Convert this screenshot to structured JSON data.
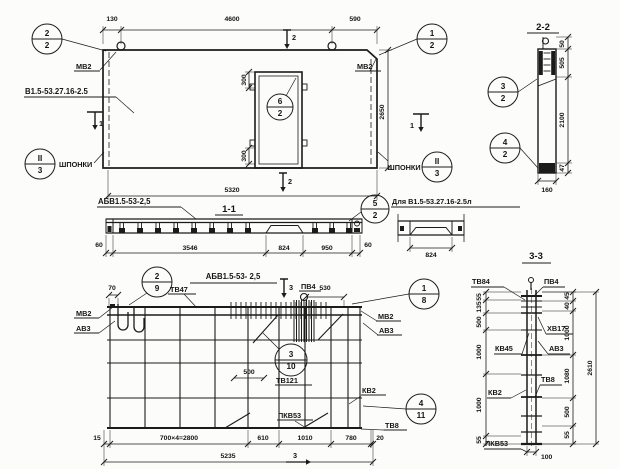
{
  "elevation": {
    "dims": {
      "offset": "130",
      "top": "4600",
      "corner": "590",
      "height": "2650",
      "length": "5320",
      "opening_top": "300",
      "opening_bottom": "300"
    },
    "labels": {
      "mv2_left": "МВ2",
      "mv2_right": "МВ2",
      "panel_mark": "В1.5-53.27.16-2.5",
      "keys_left": "ШПОНКИ",
      "keys_right": "ШПОНКИ"
    },
    "marks": {
      "m1_left": "1",
      "m1_right": "1",
      "m2_top": "2",
      "m2_bottom": "2"
    },
    "callouts": {
      "top_left": {
        "num": "2",
        "den": "2"
      },
      "top_right": {
        "num": "1",
        "den": "2"
      },
      "key_left": {
        "num": "II",
        "den": "3"
      },
      "key_right": {
        "num": "II",
        "den": "3"
      },
      "opening": {
        "num": "6",
        "den": "2"
      }
    }
  },
  "section_2_2": {
    "title": "2-2",
    "callout_top": {
      "num": "3",
      "den": "2"
    },
    "callout_bottom": {
      "num": "4",
      "den": "2"
    },
    "dims": {
      "h50": "50",
      "h505": "505",
      "h2100": "2100",
      "h47": "47",
      "w160": "160"
    }
  },
  "section_1_1": {
    "label": "АБВ1.5-53-2,5",
    "title": "1-1",
    "callout": {
      "num": "5",
      "den": "2"
    },
    "dims": [
      "60",
      "3546",
      "824",
      "950",
      "60"
    ]
  },
  "detail_l": {
    "label": "Для В1.5-53.27.16-2.5л",
    "dim": "824"
  },
  "plan": {
    "title": "АБВ1.5-53- 2,5",
    "callouts": {
      "c29": {
        "num": "2",
        "den": "9"
      },
      "c18": {
        "num": "1",
        "den": "8"
      },
      "c310": {
        "num": "3",
        "den": "10"
      },
      "c411": {
        "num": "4",
        "den": "11"
      }
    },
    "labels": {
      "mv2_left": "МВ2",
      "av3_left": "АВ3",
      "tv47": "ТВ47",
      "pv4": "ПВ4",
      "mv2_right": "МВ2",
      "av3_right": "АВ3",
      "tv121": "ТВ121",
      "kv2": "КВ2",
      "pkv53": "ПКВ53",
      "tv8": "ТВ8"
    },
    "dims": {
      "d70": "70",
      "d530": "530",
      "d500": "500",
      "bottom": [
        "15",
        "700×4=2800",
        "610",
        "1010",
        "780",
        "20"
      ],
      "total": "5235"
    },
    "marks": {
      "m3_top": "3",
      "m3_bottom": "3"
    }
  },
  "section_3_3": {
    "title": "3-3",
    "labels": {
      "tv84": "ТВ84",
      "pv4": "ПВ4",
      "hv17": "ХВ17",
      "av3": "АВ3",
      "kv45": "КВ45",
      "kv2": "КВ2",
      "tv8": "ТВ8",
      "pkv53": "ПКВ53"
    },
    "dims_left": [
      "55",
      "135",
      "500",
      "1000",
      "1000",
      "55"
    ],
    "dims_right": [
      "45",
      "40",
      "1000",
      "1080",
      "500",
      "55"
    ],
    "dim_total": "2610",
    "dim_width": "100"
  }
}
